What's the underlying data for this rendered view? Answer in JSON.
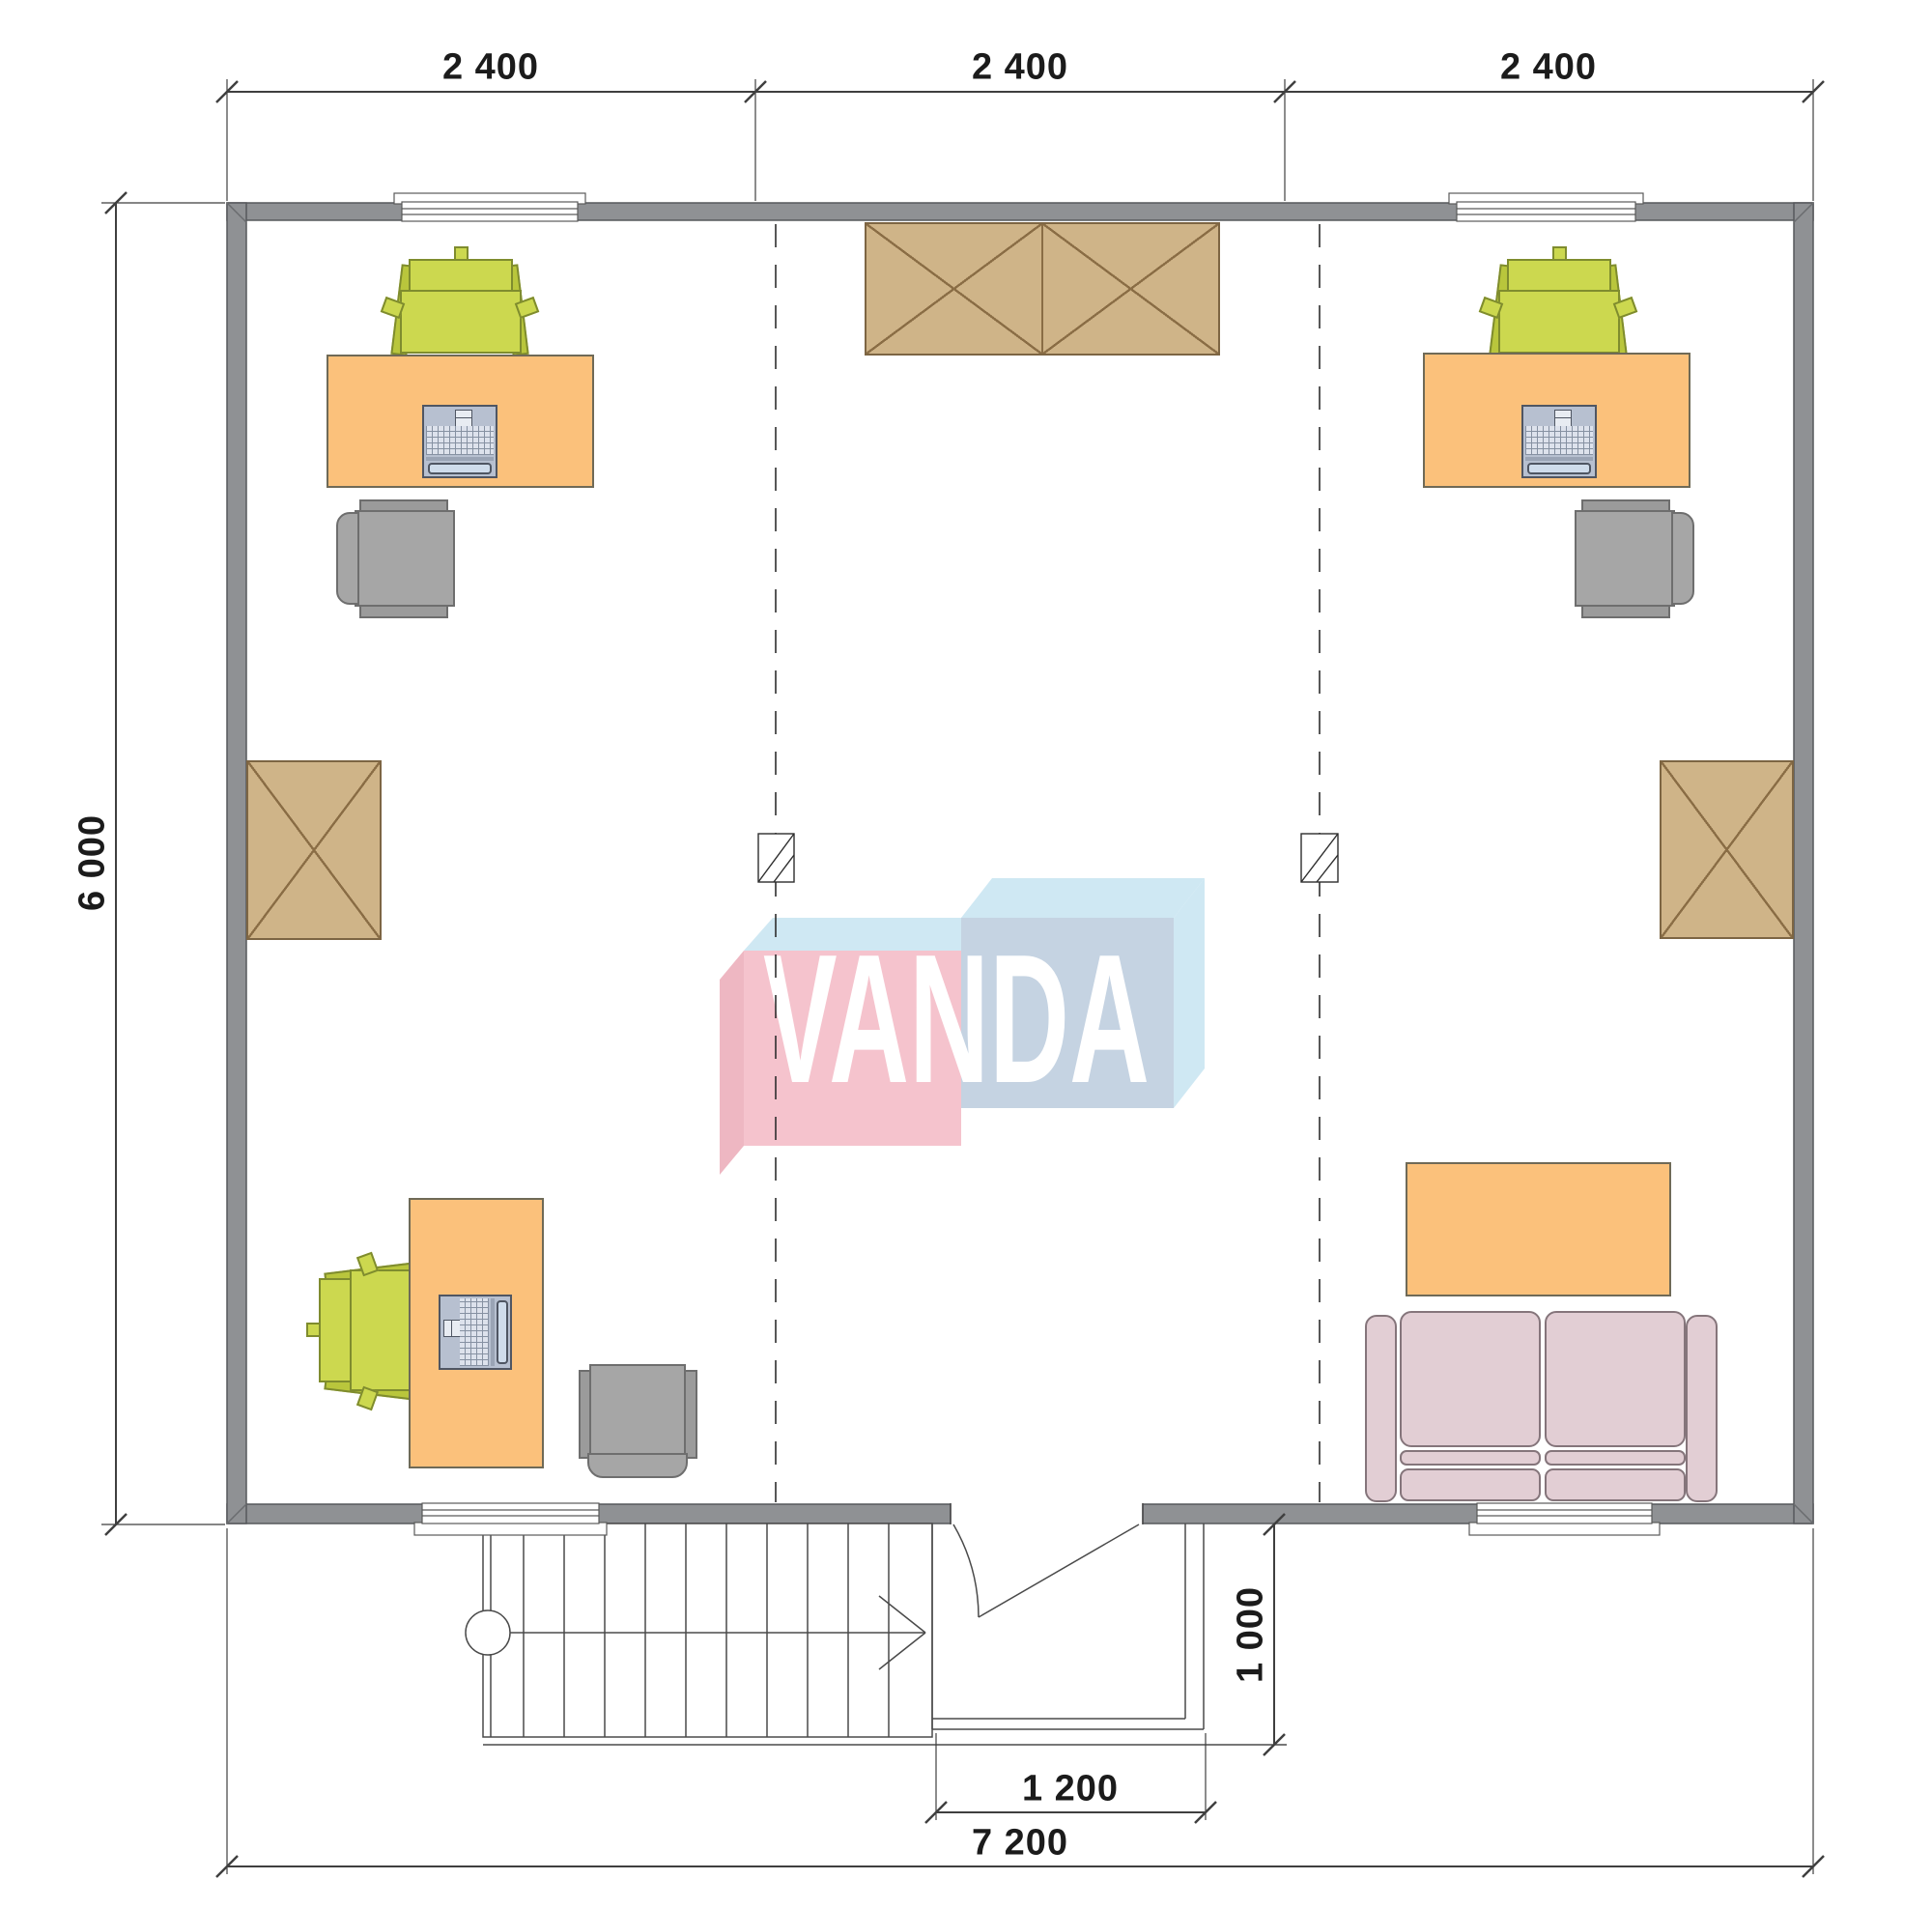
{
  "watermark": {
    "brand": "VANDA"
  },
  "dimensions": {
    "top_segments": [
      "2 400",
      "2 400",
      "2 400"
    ],
    "left_height": "6 000",
    "bottom_total": "7 200",
    "entry_width": "1 200",
    "entry_depth": "1 000"
  },
  "colors": {
    "wall": "#8f9194",
    "desk": "#fbc17b",
    "task_chair_green": "#ccd84f",
    "office_chair_gray": "#a6a6a6",
    "wardrobe": "#cfb488",
    "sofa": "#e2ced4",
    "logo_pink": "#f5c3cd",
    "logo_blue_face": "#c5d3e2",
    "logo_blue_light": "#cfe8f3",
    "dimension_line": "#3f3f3f"
  },
  "furniture_icons": [
    "desk-with-laptop-top-left",
    "desk-with-laptop-top-right",
    "desk-with-laptop-bottom-left",
    "wardrobe-double-top-center",
    "wardrobe-left-wall",
    "wardrobe-right-wall",
    "office-chair-top-left",
    "office-chair-top-right",
    "office-chair-bottom-left",
    "sofa-bottom-right",
    "coffee-table-bottom-right",
    "staircase-with-direction-arrow",
    "entry-porch",
    "door-swing"
  ]
}
